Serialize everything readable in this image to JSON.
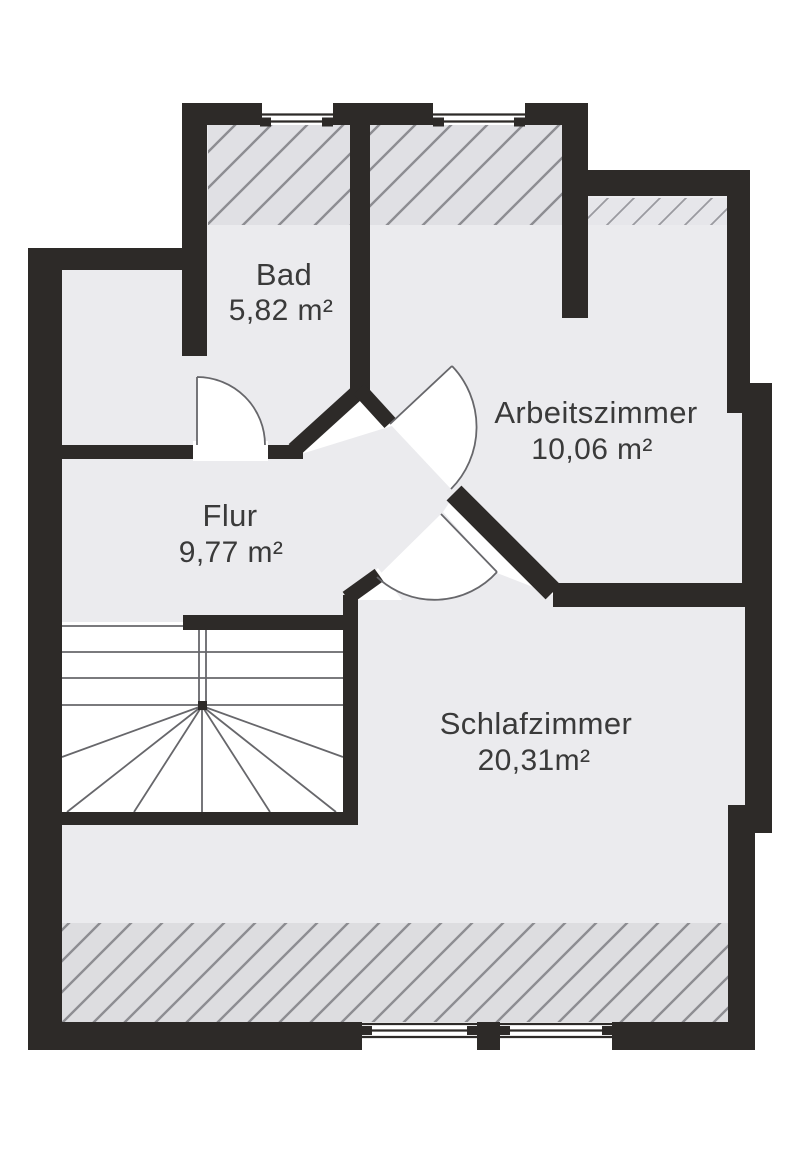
{
  "plan": {
    "type": "floor-plan",
    "rooms": [
      {
        "id": "bad",
        "name": "Bad",
        "area": "5,82 m²"
      },
      {
        "id": "arbeitszimmer",
        "name": "Arbeitszimmer",
        "area": "10,06 m²"
      },
      {
        "id": "flur",
        "name": "Flur",
        "area": "9,77 m²"
      },
      {
        "id": "schlafzimmer",
        "name": "Schlafzimmer",
        "area": "20,31m²"
      }
    ],
    "colors": {
      "wall": "#2d2a28",
      "floor": "#ebebee",
      "roof_slope_hatch_fill": "#e0e0e4",
      "roof_slope_hatch_line": "#8d8d92",
      "band_hatch_fill": "#e6e6ea",
      "band_hatch_line": "#9a9aa0",
      "lower_hatch_fill": "#dddde0",
      "thin_line": "#67676b",
      "text": "#3a3a3a",
      "background": "#ffffff",
      "stair_fill": "#ffffff"
    }
  }
}
